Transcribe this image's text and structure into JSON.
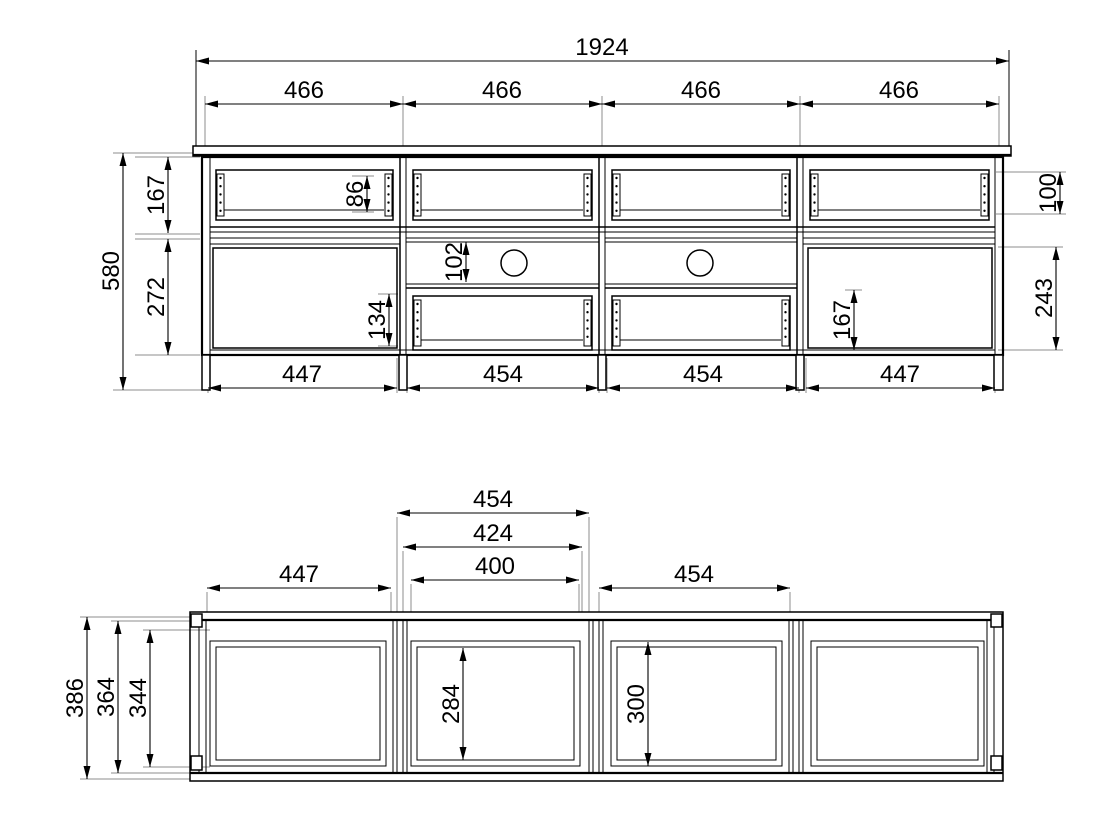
{
  "document": {
    "type": "furniture technical drawing",
    "views": [
      "front elevation",
      "plan section"
    ],
    "line_color": "#000000",
    "extension_line_color": "#8c8c8c",
    "background": "#ffffff"
  },
  "front_view": {
    "total_width": "1924",
    "sections": [
      "466",
      "466",
      "466",
      "466"
    ],
    "height_total": "580",
    "height_top_row": "167",
    "height_door_left": "272",
    "drawer_back_height": "86",
    "niche_height": "102",
    "drawer2_height": "134",
    "drawer_front_height": "100",
    "door_right_height": "243",
    "right_inner_height": "167",
    "bottom_widths": [
      "447",
      "454",
      "454",
      "447"
    ],
    "cable_holes": 2
  },
  "plan_view": {
    "section2_pitch": "454",
    "section2_opening": "424",
    "section2_clear": "400",
    "section1_width": "447",
    "section3_width": "454",
    "depth_total": "386",
    "depth_body": "364",
    "depth_inner": "344",
    "inner_depth_s2": "284",
    "inner_depth_s3": "300"
  }
}
